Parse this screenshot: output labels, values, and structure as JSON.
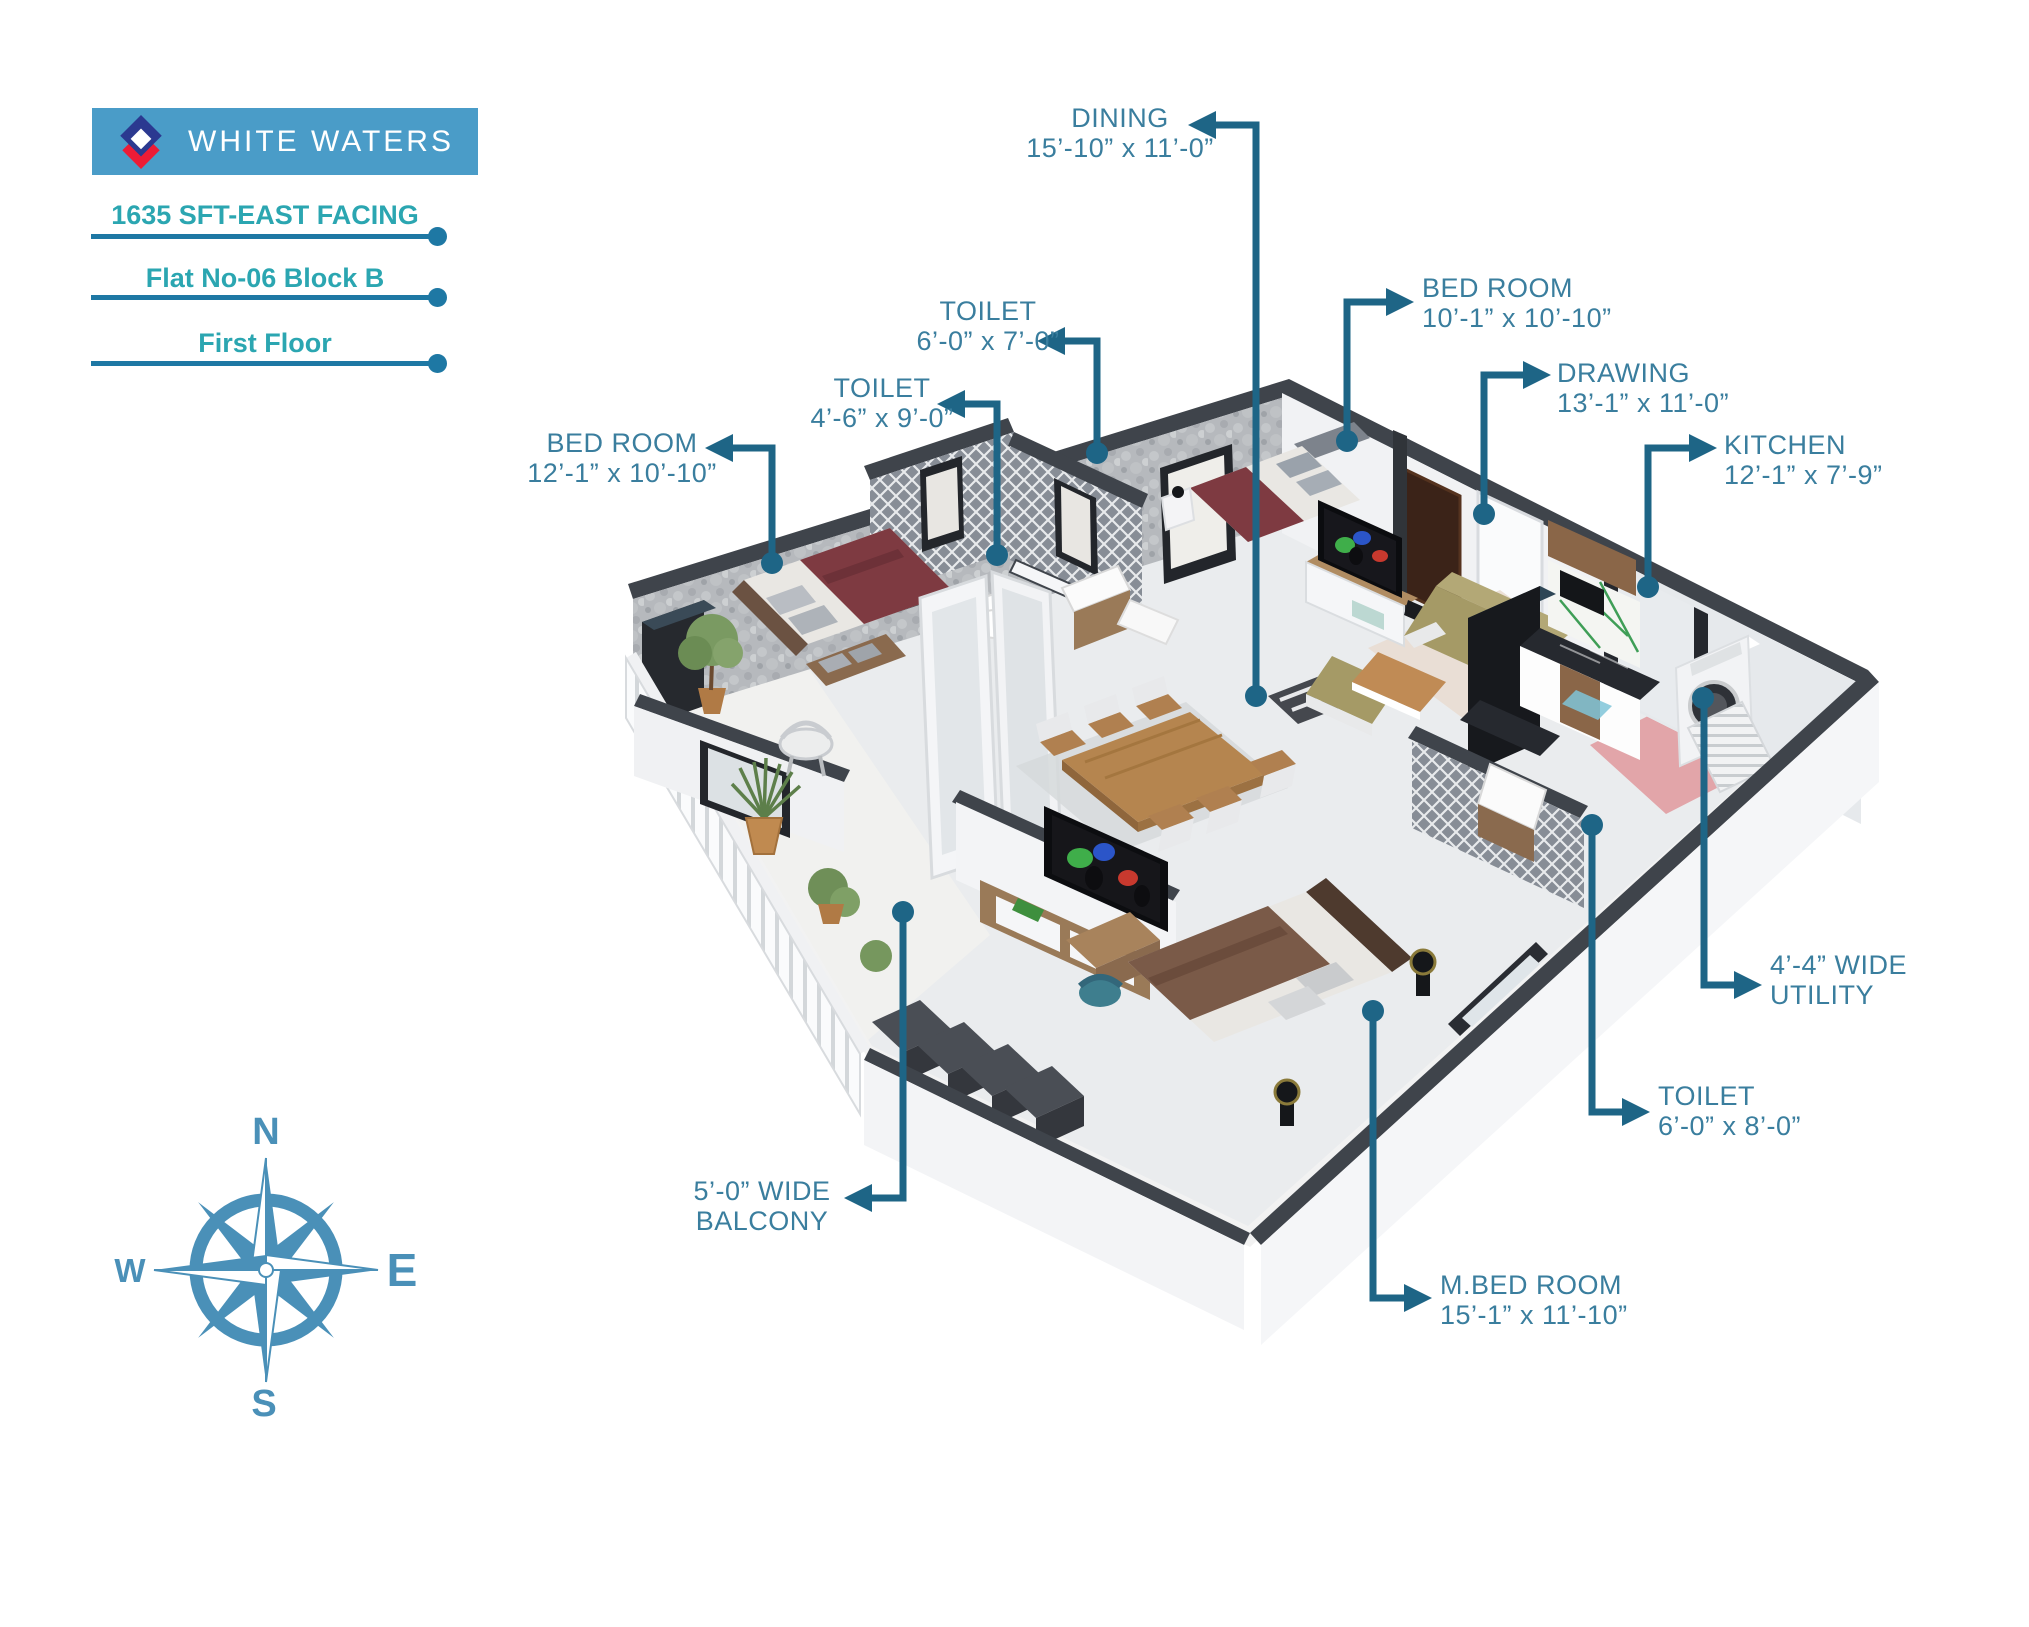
{
  "header": {
    "brand": "WHITE WATERS",
    "area_facing": "1635 SFT-EAST FACING",
    "flat": "Flat No-06 Block B",
    "floor": "First Floor",
    "logo_icon": "diamond-logo"
  },
  "rooms": [
    {
      "id": "dining",
      "line1": "DINING",
      "line2": "15’-10” x 11’-0”"
    },
    {
      "id": "toilet1",
      "line1": "TOILET",
      "line2": "6’-0” x 7’-0”"
    },
    {
      "id": "toilet2",
      "line1": "TOILET",
      "line2": "4’-6” x 9’-0”"
    },
    {
      "id": "bedroom1",
      "line1": "BED ROOM",
      "line2": "12’-1” x 10’-10”"
    },
    {
      "id": "bedroom2",
      "line1": "BED ROOM",
      "line2": "10’-1” x 10’-10”"
    },
    {
      "id": "drawing",
      "line1": "DRAWING",
      "line2": "13’-1” x 11’-0”"
    },
    {
      "id": "kitchen",
      "line1": "KITCHEN",
      "line2": "12’-1” x 7’-9”"
    },
    {
      "id": "utility",
      "line1": "4’-4” WIDE",
      "line2": "UTILITY"
    },
    {
      "id": "toilet3",
      "line1": "TOILET",
      "line2": "6’-0” x 8’-0”"
    },
    {
      "id": "mbedroom",
      "line1": "M.BED ROOM",
      "line2": "15’-1” x 11’-10”"
    },
    {
      "id": "balcony",
      "line1": "5’-0” WIDE",
      "line2": "BALCONY"
    }
  ],
  "compass": {
    "n": "N",
    "e": "E",
    "s": "S",
    "w": "W"
  },
  "colors": {
    "banner_bg": "#4A9CC8",
    "teal": "#2BA6B1",
    "underline": "#1E78A4",
    "label_text": "#3A7E9E",
    "leader": "#1E6586",
    "compass": "#4A90B8",
    "logo_navy": "#2B3990",
    "logo_red": "#ED1C36"
  }
}
